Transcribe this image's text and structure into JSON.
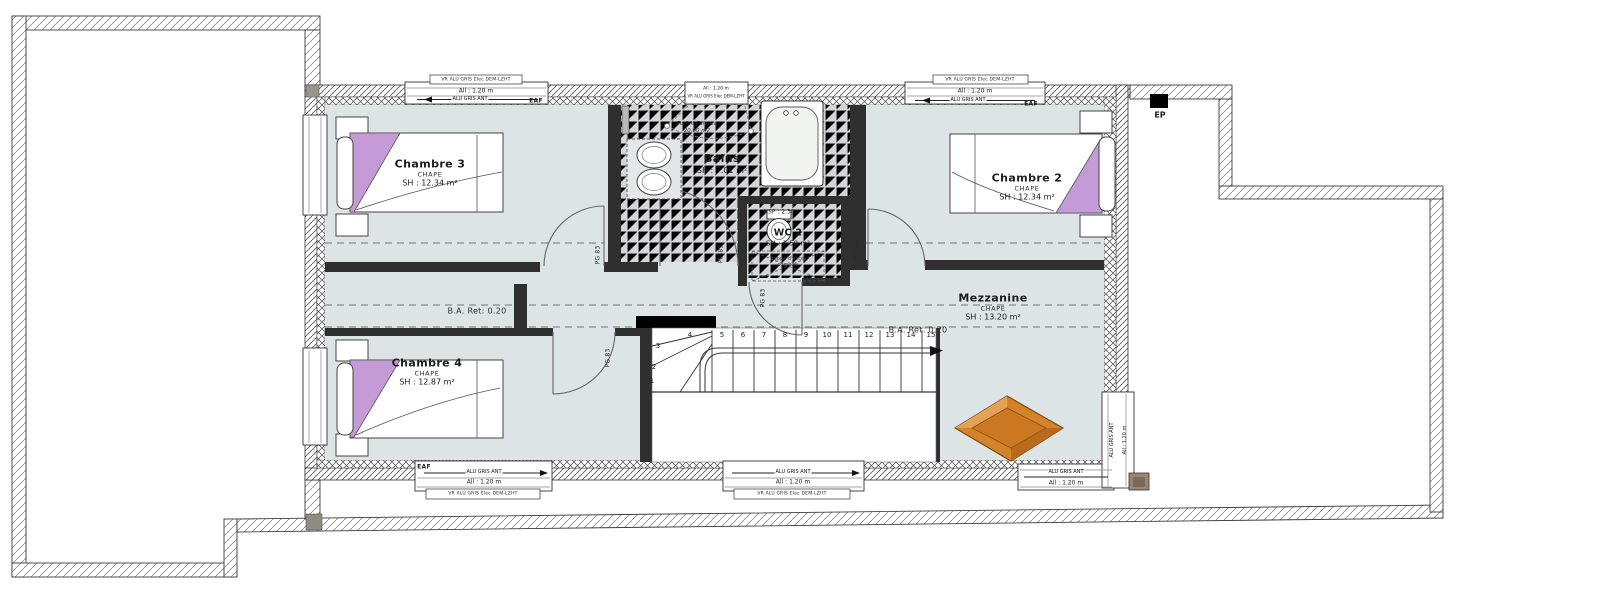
{
  "plan": {
    "rooms": {
      "chambre3": {
        "name": "Chambre 3",
        "finish": "CHAPE",
        "area": "SH : 12.34 m²"
      },
      "chambre2": {
        "name": "Chambre 2",
        "finish": "CHAPE",
        "area": "SH : 12.34 m²"
      },
      "chambre4": {
        "name": "Chambre 4",
        "finish": "CHAPE",
        "area": "SH : 12.87 m²"
      },
      "mezzanine": {
        "name": "Mezzanine",
        "finish": "CHAPE",
        "area": "SH : 13.20 m²"
      },
      "bains": {
        "name": "Bains",
        "area": "SH : 7.01 m²"
      },
      "wc2": {
        "name": "WC 2",
        "area": "SH : 1.50 m²",
        "ceiling_height": "HSP : 2.30",
        "hatch_line1": "Trappe d'accès",
        "hatch_line2": "combles"
      }
    },
    "annotations": {
      "faience_line1": "Forfait Faïence",
      "faience_line2": "20.00 m2",
      "ba_ret_left": "B.A. Ret: 0.20",
      "ba_ret_right": "B.A. Ret. 0.20",
      "rainwater": "EP",
      "air_inlet": "EAF",
      "door_label": "PG 83"
    },
    "windows": {
      "roller_shutter": "VR ALU GRIS Elec DEM-LZHT",
      "sill": "All : 1.20 m",
      "frame": "ALU GRIS ANT"
    },
    "stairs": {
      "numbers": [
        "1",
        "2",
        "3",
        "4",
        "5",
        "6",
        "7",
        "8",
        "9",
        "10",
        "11",
        "12",
        "13",
        "14",
        "15"
      ]
    }
  },
  "colors": {
    "floor": "#dde4e6",
    "tile": "#d2d6d7",
    "wall": "#2f2f2f",
    "accent_purple": "#c49bd6",
    "skylight_orange": "#d5832b"
  }
}
